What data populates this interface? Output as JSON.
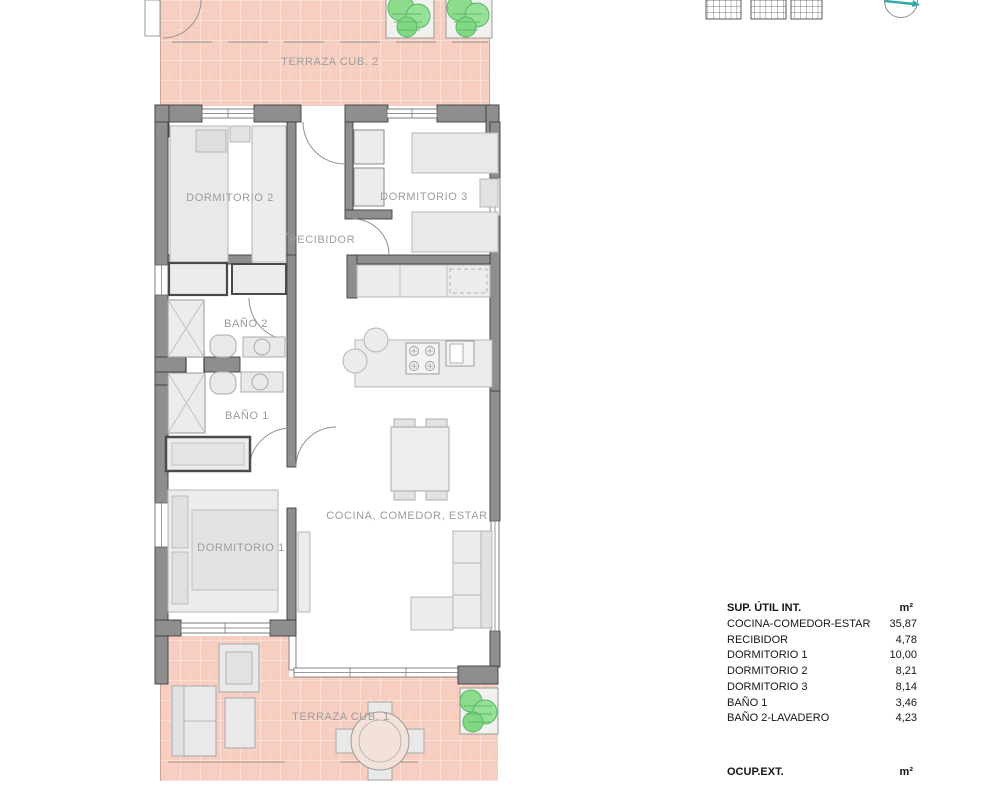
{
  "plan": {
    "rooms": {
      "terraza2": "TERRAZA CUB. 2",
      "dormitorio2": "DORMITORIO 2",
      "recibidor": "RECIBIDOR",
      "dormitorio3": "DORMITORIO 3",
      "bano2": "BAÑO 2",
      "bano1": "BAÑO 1",
      "dormitorio1": "DORMITORIO 1",
      "cocina_comedor_estar": "COCINA, COMEDOR, ESTAR",
      "terraza1": "TERRAZA CUB. 1"
    },
    "icons": [
      "pergola-grid",
      "pergola-grid",
      "pergola-grid",
      "north-compass"
    ]
  },
  "area_table": {
    "title": "SUP. ÚTIL INT.",
    "unit": "m²",
    "rows": [
      {
        "name": "COCINA-COMEDOR-ESTAR",
        "value": "35,87"
      },
      {
        "name": "RECIBIDOR",
        "value": "4,78"
      },
      {
        "name": "DORMITORIO 1",
        "value": "10,00"
      },
      {
        "name": "DORMITORIO 2",
        "value": "8,21"
      },
      {
        "name": "DORMITORIO 3",
        "value": "8,14"
      },
      {
        "name": "BAÑO 1",
        "value": "3,46"
      },
      {
        "name": "BAÑO 2-LAVADERO",
        "value": "4,23"
      }
    ]
  },
  "ext_table": {
    "title": "OCUP.EXT.",
    "unit": "m²"
  },
  "colors": {
    "terrace_tile": "#F6CDBF",
    "terrace_grout": "#FBE3DA",
    "wall": "#8E8E8E",
    "wall_edge": "#3F3F3F",
    "furniture": "#E9E9E9",
    "furniture_stroke": "#B5B5B5",
    "label_text": "#9C9C9C",
    "plant_green": "#8BDC8B",
    "compass_accent": "#2FA9A5",
    "table_text": "#161616"
  }
}
